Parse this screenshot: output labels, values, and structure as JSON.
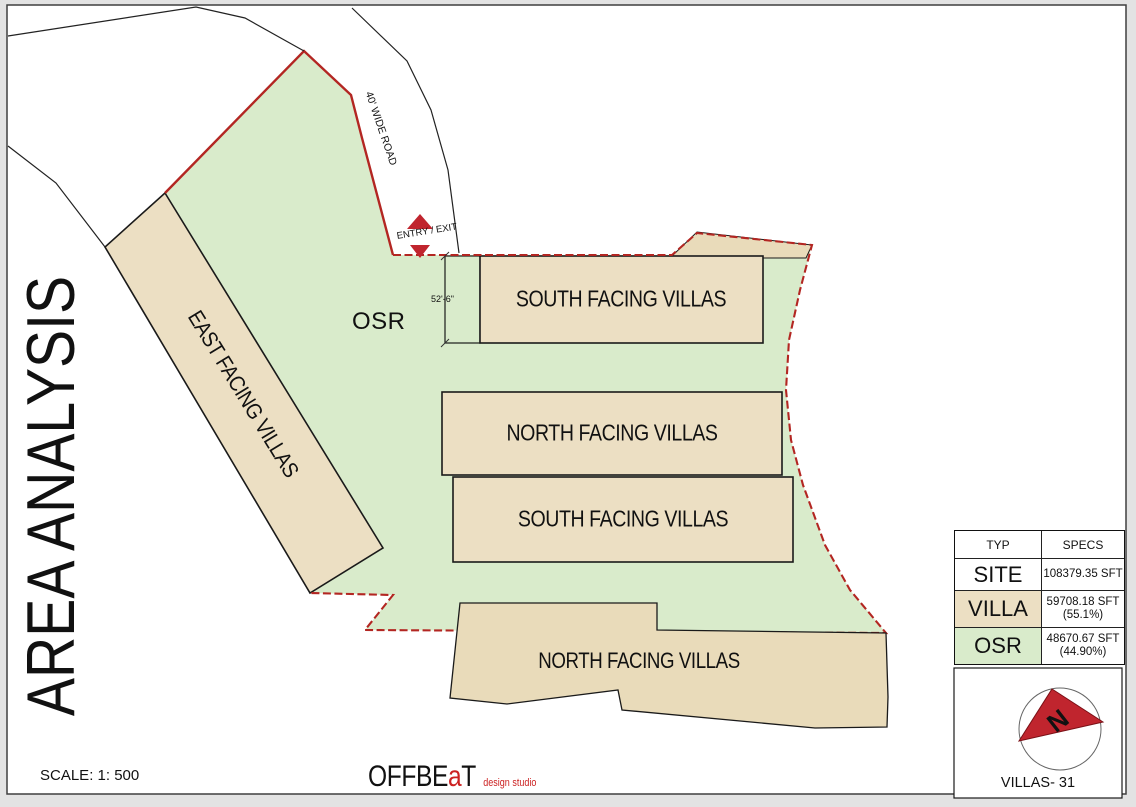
{
  "title": "AREA ANALYSIS",
  "scale_label": "SCALE: 1: 500",
  "brand": {
    "part1": "OFFBE",
    "accent": "a",
    "part2": "T",
    "tagline": "design studio"
  },
  "plan": {
    "osr_label": "OSR",
    "road_label": "40' WIDE ROAD",
    "entry_exit_label": "ENTRY / EXIT",
    "dimension_label": "52'-6\"",
    "blocks": {
      "east": "EAST FACING VILLAS",
      "south_top": "SOUTH FACING VILLAS",
      "north_mid": "NORTH FACING VILLAS",
      "south_mid": "SOUTH FACING VILLAS",
      "north_bottom": "NORTH FACING VILLAS"
    }
  },
  "area_table": {
    "headers": [
      "TYP",
      "SPECS"
    ],
    "rows": [
      {
        "typ": "SITE",
        "specs": "108379.35 SFT",
        "pct": ""
      },
      {
        "typ": "VILLA",
        "specs": "59708.18 SFT",
        "pct": "(55.1%)"
      },
      {
        "typ": "OSR",
        "specs": "48670.67 SFT",
        "pct": "(44.90%)"
      }
    ]
  },
  "compass": {
    "north_letter": "N",
    "caption": "VILLAS- 31"
  },
  "colors": {
    "osr_green": "#d9ebcb",
    "villa_tan": "#ecdfc3",
    "villa_tan_dark": "#e9dbba",
    "boundary_red": "#b32622",
    "marker_red": "#c0252e",
    "outline_black": "#1a1a1a"
  }
}
